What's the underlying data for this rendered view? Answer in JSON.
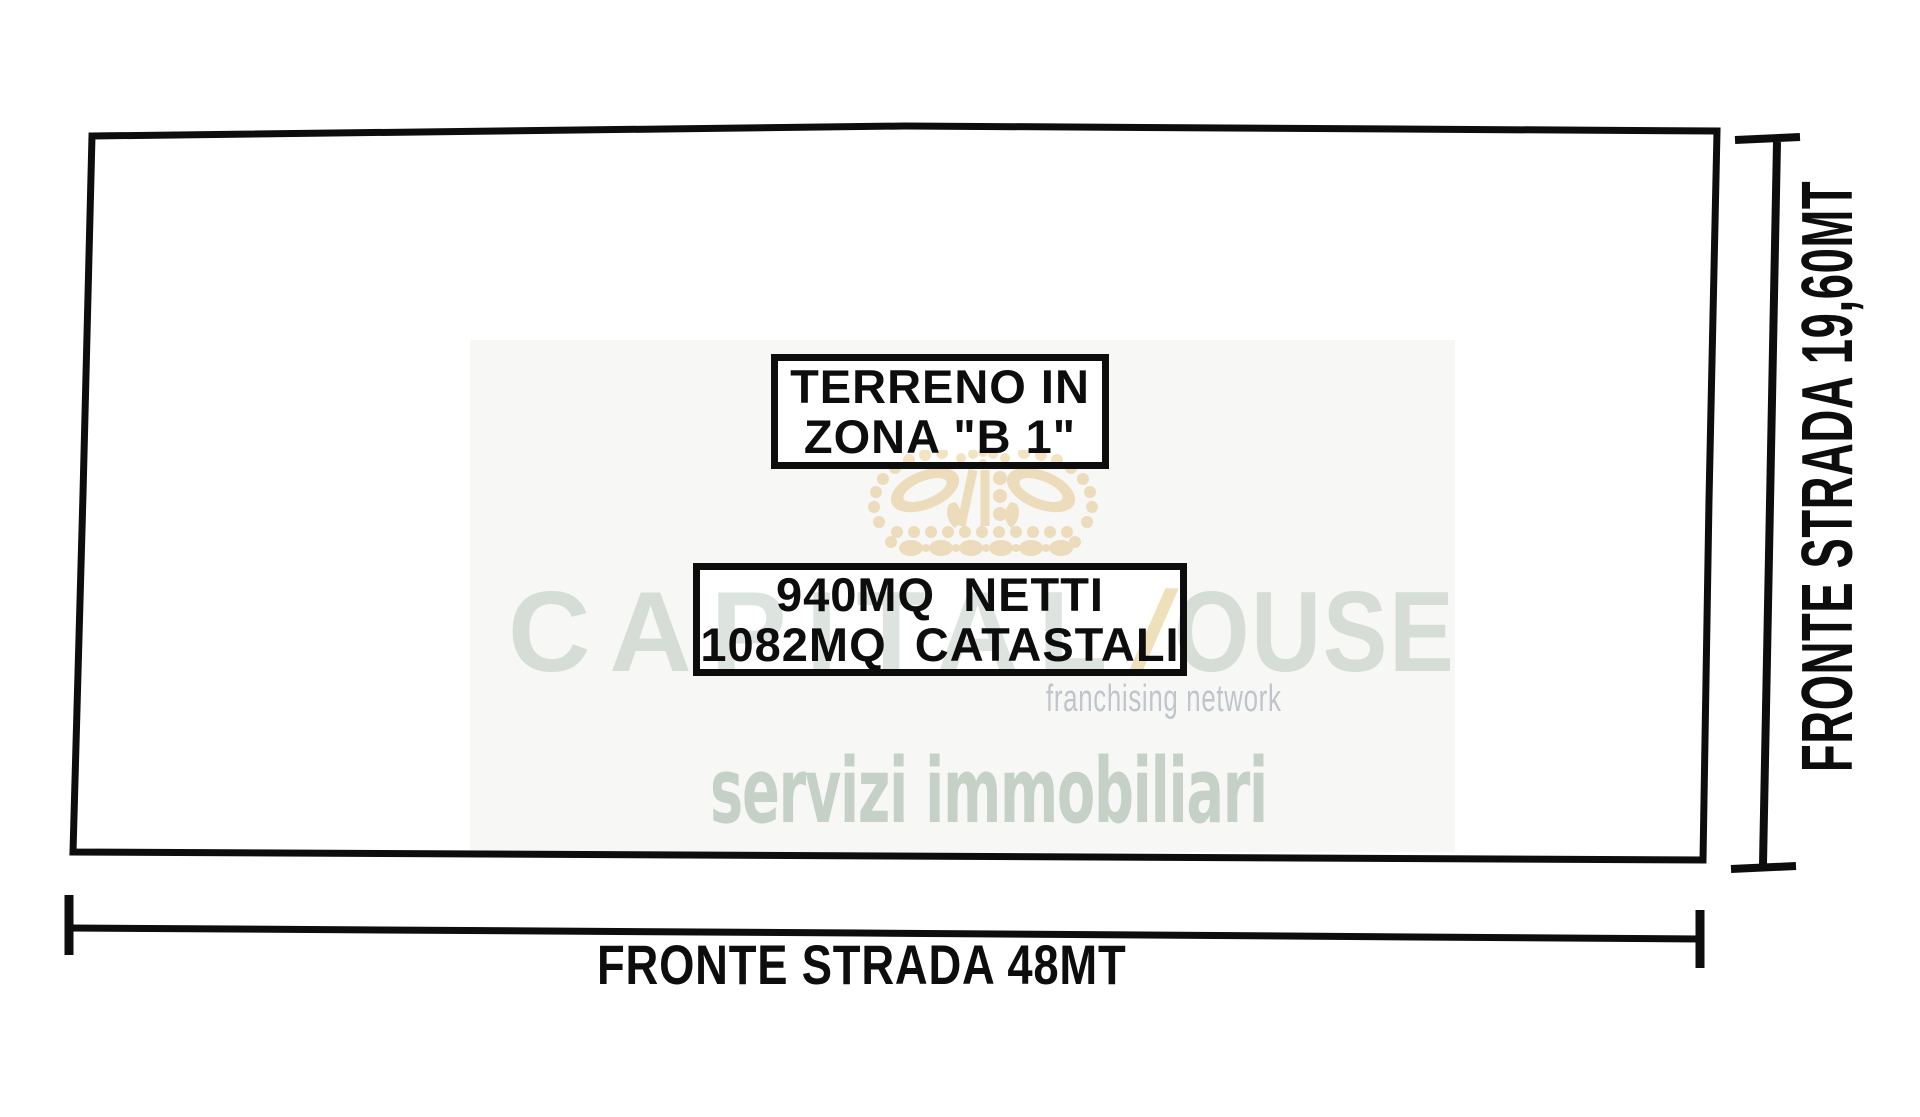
{
  "diagram": {
    "zone_box": {
      "line1": "TERRENO IN",
      "line2": "ZONA \"B 1\""
    },
    "area_box": {
      "line1": "940MQ  NETTI",
      "line2": "1082MQ  CATASTALI"
    },
    "dimension_bottom": {
      "label": "FRONTE STRADA 48MT"
    },
    "dimension_right": {
      "label": "FRONTE STRADA 19,60MT"
    },
    "ink_color": "#0d0d0d"
  },
  "watermark": {
    "brand_part1": "CAPITAL",
    "brand_separator": "/",
    "brand_part2": "OUSE",
    "subtitle": "franchising network",
    "tagline": "servizi immobiliari",
    "crown_icon": "crown-icon",
    "colors": {
      "crown": "#f4e3c3",
      "brand_text": "#dde4df",
      "separator": "#eee0bb",
      "subtitle_text": "#c6ccd4",
      "tagline_text": "#ccd8cf",
      "wash": "#f7f7f5"
    }
  }
}
